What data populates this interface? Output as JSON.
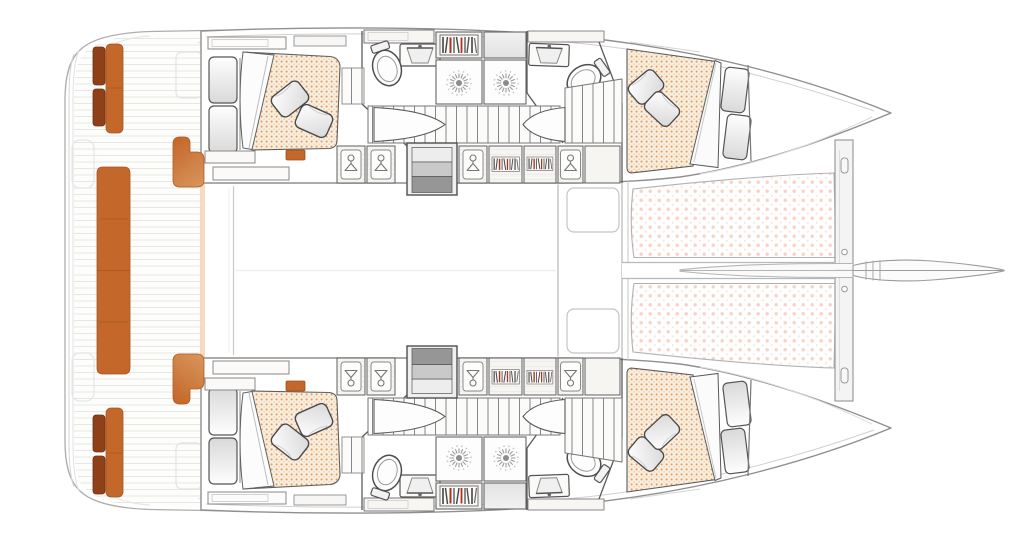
{
  "meta": {
    "description": "Overhead floor plan of a sailing catamaran: four double cabins, four bathrooms with showers, twin hull staircases, aft cockpit with orange upholstery, bow trampoline nets and bowsprit",
    "visible_text": []
  },
  "colors": {
    "accent_orange": "#C4672A",
    "cushion_brown": "#8F4019",
    "bench_fade": "#D9985F",
    "mattress_bg": "#F8EFE1",
    "mattress_dot": "#E08840",
    "trampoline_dot": "#F2C4B0",
    "book_red": "#A93523",
    "step_light": "#EDEDED",
    "step_mid": "#C9C9C9",
    "step_dark": "#969696",
    "hull_outline": "#8F8F8F",
    "wall": "#5A5A5A"
  },
  "legend": {
    "hanger-icon": "hanging locker / wardrobe",
    "books-icon": "book shelf",
    "shower-icon": "overhead shower head",
    "toilet-icon": "marine toilet",
    "sink-icon": "wash basin with mirror shelf",
    "dotted-fabric": "double berth mattress",
    "dotted-net": "bow trampoline net",
    "lens-shape": "door swing across staircase",
    "orange-blocks": "cockpit bench upholstery"
  },
  "fixtures": {
    "double_berths": 4,
    "pillows_per_berth": 2,
    "toilets": 4,
    "wash_basins": 4,
    "showers": 4,
    "hanging_lockers": 8,
    "book_shelves": 6,
    "hull_staircases": 2,
    "companionway_steps": 2,
    "trampoline_nets": 2,
    "bowsprit": 1,
    "cockpit": {
      "transom_bench": 1,
      "side_bench_seats": 2,
      "entry_seats": 2
    }
  }
}
